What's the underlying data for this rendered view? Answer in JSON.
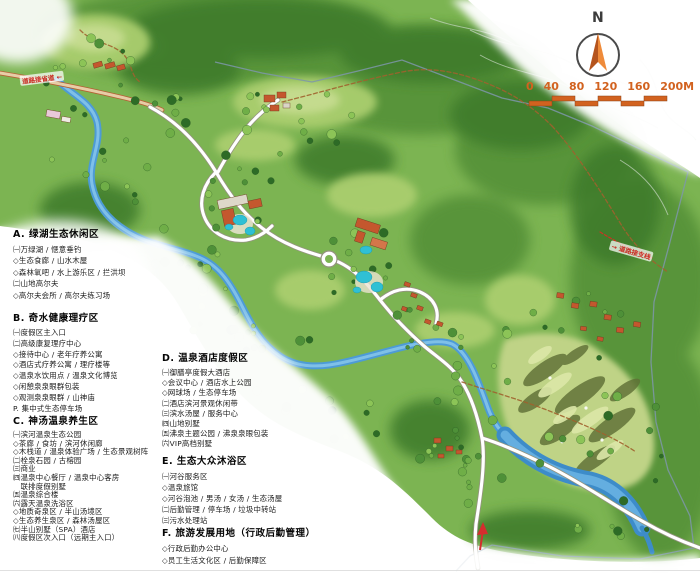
{
  "compass": {
    "north_label": "N"
  },
  "scale_bar": {
    "labels": [
      "0",
      "40",
      "80",
      "120",
      "160",
      "200M"
    ]
  },
  "road_labels": {
    "top_left": "道路接省道 ←",
    "right": "→ 道路接支线"
  },
  "legend": {
    "sections": [
      {
        "letter": "A",
        "heading": "A. 绿湖生态休闲区",
        "items": [
          "㈠万绿湖 / 惬意垂钓",
          "◇生态食廊 / 山水木屋",
          "◇森林氧吧 / 水上游乐区 / 拦洪坝",
          "㈡山地高尔夫",
          "◇高尔夫会所 / 高尔夫练习场"
        ]
      },
      {
        "letter": "B",
        "heading": "B. 奇水健康理疗区",
        "items": [
          "㈠度假区主入口",
          "㈡高级康复理疗中心",
          "◇接待中心 / 老年疗养公寓",
          "◇酒店式疗养公寓 / 理疗楼等",
          "◇温泉水饮用点 / 温泉文化博览",
          "◇闲憩泉泉眼群包装",
          "◇观测泉泉眼群 / 山神庙",
          "P. 集中式生态停车场"
        ]
      },
      {
        "letter": "C",
        "heading": "C. 神汤温泉养生区",
        "items": [
          "㈠滨河温泉生态公园",
          "◇茶廊 / 食坊 / 滨河休闲廊",
          "◇木栈道 / 温泉体验广场 / 生态景观树阵",
          "㈡栓泉石园 / 古榕园",
          "㈢商业",
          "㈣温泉中心餐厅 / 温泉中心客房",
          "　联排度假别墅",
          "㈤温泉综合楼",
          "㈥露天温泉洗浴区",
          "◇地质奇泉区 / 半山汤境区",
          "◇生态养生泉区 / 森林汤屋区",
          "㈦半山别墅（SPA）酒店",
          "㈧度假区次入口（远期主入口）"
        ]
      },
      {
        "letter": "D",
        "heading": "D. 温泉酒店度假区",
        "items": [
          "㈠御膳亭度假大酒店",
          "◇会议中心 / 酒店水上公园",
          "◇网球场 / 生态停车场",
          "㈡酒店滨河景观休闲带",
          "㈢滨水汤屋 / 服务中心",
          "㈣山地别墅",
          "㈤沸泉主题公园 / 沸泉泉眼包装",
          "㈥VIP高档别墅"
        ]
      },
      {
        "letter": "E",
        "heading": "E. 生态大众沐浴区",
        "items": [
          "㈠河谷服务区",
          "◇温泉旅馆",
          "◇河谷泡池 / 男汤 / 女汤 / 生态汤屋",
          "㈡后勤管理 / 停车场 / 垃圾中转站",
          "㈢污水处理站"
        ]
      },
      {
        "letter": "F",
        "heading": "F. 旅游发展用地（行政后勤管理）",
        "items": [
          "◇行政后勤办公中心",
          "◇员工生活文化区 / 后勤保障区"
        ]
      }
    ]
  },
  "colors": {
    "terrain_green": "#7cb452",
    "forest_dark": "#3c7a2b",
    "river_blue": "#4d9bd6",
    "pool_cyan": "#2fc0d4",
    "road_white": "#ffffff",
    "access_road_tan": "#e6cda6",
    "scale_orange": "#d2621f",
    "label_red": "#c92a21",
    "boundary_slate": "#7e97aa"
  }
}
